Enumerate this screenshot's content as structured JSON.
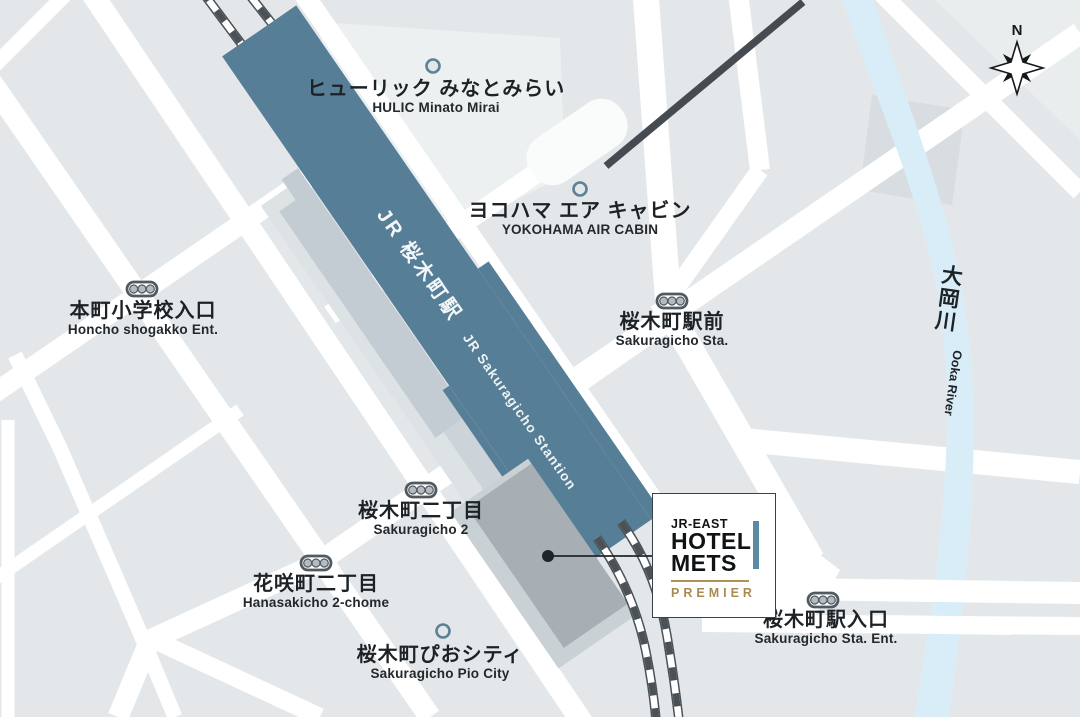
{
  "map": {
    "compass_label": "N",
    "station": {
      "jp": "JR 桜木町駅",
      "en": "JR Sakuragicho Stantion"
    },
    "hotel_box": {
      "brand": "JR-EAST",
      "line1": "HOTEL",
      "line2": "METS",
      "tier": "PREMIER"
    },
    "labels": [
      {
        "id": "hulic",
        "jp": "ヒューリック みなとみらい",
        "en": "HULIC Minato Mirai",
        "marker": "circle"
      },
      {
        "id": "aircabin",
        "jp": "ヨコハマ エア キャビン",
        "en": "YOKOHAMA AIR CABIN",
        "marker": "circle"
      },
      {
        "id": "honcho",
        "jp": "本町小学校入口",
        "en": "Honcho shogakko Ent.",
        "marker": "signal"
      },
      {
        "id": "ekimae",
        "jp": "桜木町駅前",
        "en": "Sakuragicho Sta.",
        "marker": "signal"
      },
      {
        "id": "sakuragicho2",
        "jp": "桜木町二丁目",
        "en": "Sakuragicho 2",
        "marker": "signal"
      },
      {
        "id": "hanasakicho",
        "jp": "花咲町二丁目",
        "en": "Hanasakicho 2-chome",
        "marker": "signal"
      },
      {
        "id": "pio",
        "jp": "桜木町ぴおシティ",
        "en": "Sakuragicho Pio City",
        "marker": "circle"
      },
      {
        "id": "iriguchi",
        "jp": "桜木町駅入口",
        "en": "Sakuragicho Sta. Ent.",
        "marker": "signal"
      },
      {
        "id": "ooka_river",
        "jp": "大岡川",
        "en": "Ooka River",
        "marker": "none"
      }
    ],
    "colors": {
      "road": "#ffffff",
      "block": "#e4e7e9",
      "station": "#567f97",
      "platform": "#c2ccd2",
      "river": "#d9edf8",
      "hotel_building": "#a7afb4",
      "track_dark": "#4b5257",
      "cable_dark": "#454b50",
      "accent_bar": "#5b8aa2",
      "premier_gold": "#a98b52",
      "text": "#1d2226"
    }
  }
}
